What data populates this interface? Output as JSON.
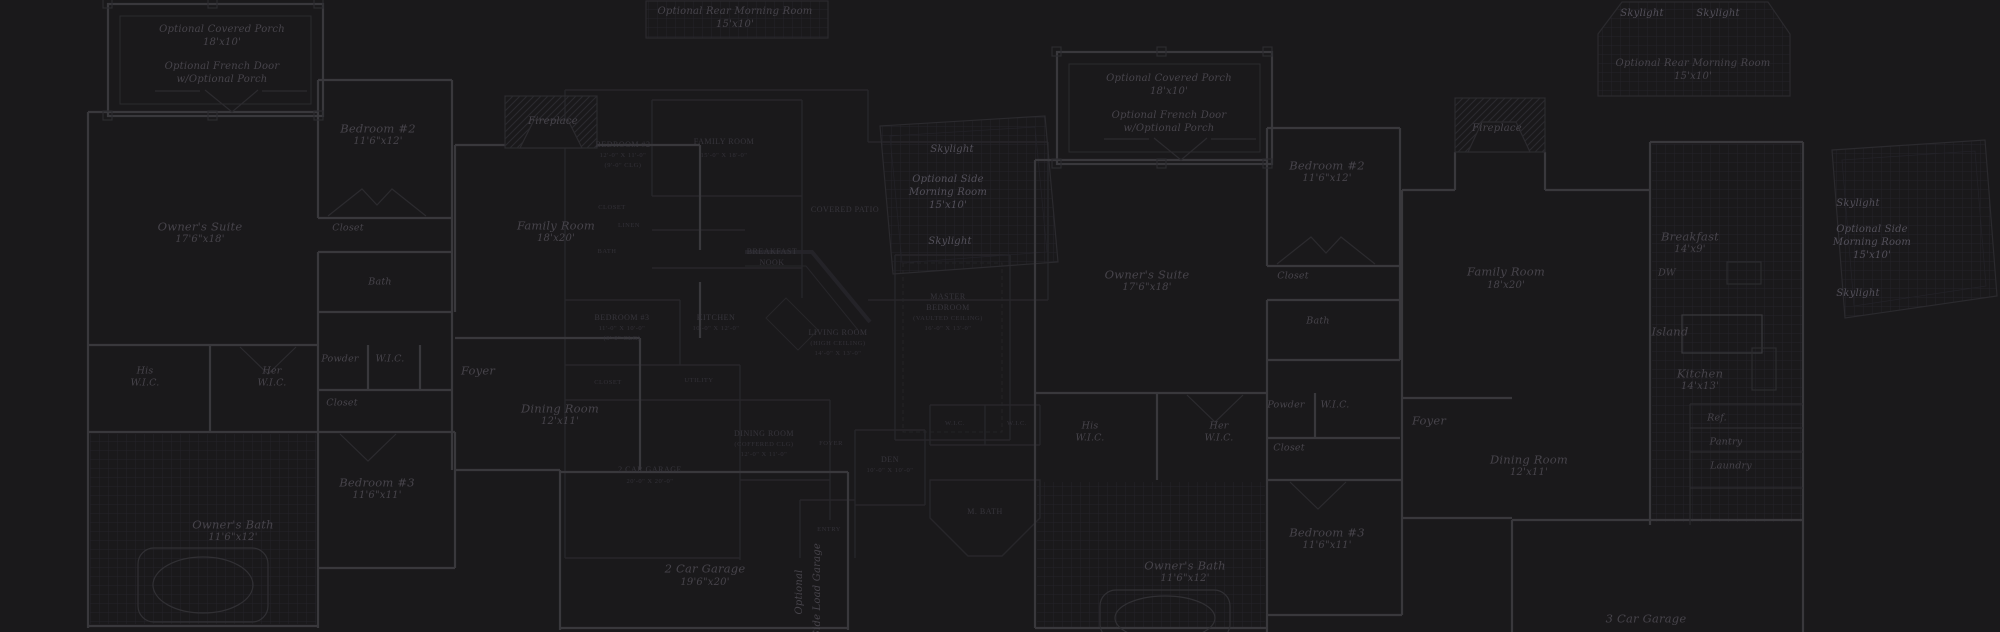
{
  "canvas": {
    "background": "#1a191b",
    "wall_color": "#39383c",
    "faint_wall_color": "#27262a",
    "label_color": "#47444b",
    "caps_label_color": "#37353c",
    "skylight_label_color": "#53505a"
  },
  "plan_left": {
    "covered_porch": {
      "title": "Optional Covered Porch",
      "dims": "18'x10'"
    },
    "french_door": {
      "line1": "Optional French Door",
      "line2": "w/Optional Porch"
    },
    "rear_morning_room": {
      "title": "Optional Rear Morning Room",
      "dims": "15'x10'"
    },
    "skylight_top": "Skylight",
    "side_morning_room": {
      "line1": "Optional Side",
      "line2": "Morning Room",
      "dims": "15'x10'"
    },
    "skylight_bottom": "Skylight",
    "bedroom2": {
      "name": "Bedroom #2",
      "dims": "11'6\"x12'"
    },
    "bedroom2_closet": "Closet",
    "owners_suite": {
      "name": "Owner's Suite",
      "dims": "17'6\"x18'"
    },
    "bath": "Bath",
    "fireplace": "Fireplace",
    "family_room": {
      "name": "Family Room",
      "dims": "18'x20'"
    },
    "his_wic": {
      "line1": "His",
      "line2": "W.I.C."
    },
    "her_wic": {
      "line1": "Her",
      "line2": "W.I.C."
    },
    "powder": "Powder",
    "wic": "W.I.C.",
    "hall_closet": "Closet",
    "foyer": "Foyer",
    "dining_room": {
      "name": "Dining Room",
      "dims": "12'x11'"
    },
    "bedroom3": {
      "name": "Bedroom #3",
      "dims": "11'6\"x11'"
    },
    "owners_bath": {
      "name": "Owner's Bath",
      "dims": "11'6\"x12'"
    },
    "garage": {
      "name": "2 Car Garage",
      "dims": "19'6\"x20'"
    },
    "side_load_garage": {
      "line1": "Optional",
      "line2": "Side Load Garage"
    }
  },
  "plan_middle": {
    "bedroom2": {
      "lines": [
        "BEDROOM #2",
        "12'-0\" X 11'-0\"",
        "(9'-0\" CLG)"
      ]
    },
    "closet": "CLOSET",
    "linen": "LINEN",
    "bath": "BATH",
    "family_room": {
      "lines": [
        "FAMILY ROOM",
        "15'-0\" X 18'-0\""
      ]
    },
    "breakfast_nook": {
      "lines": [
        "BREAKFAST",
        "NOOK"
      ]
    },
    "kitchen": {
      "lines": [
        "KITCHEN",
        "10'-0\" X 12'-0\""
      ]
    },
    "bedroom3": {
      "lines": [
        "BEDROOM #3",
        "11'-0\" X 10'-0\"",
        "(9'-0\" CLG)"
      ]
    },
    "living_room": {
      "lines": [
        "LIVING ROOM",
        "(HIGH CEILING)",
        "14'-0\" X 13'-0\""
      ]
    },
    "master_bedroom": {
      "lines": [
        "MASTER",
        "BEDROOM",
        "(VAULTED CEILING)",
        "16'-0\" X 13'-0\""
      ]
    },
    "covered_patio": "COVERED PATIO",
    "utility": "UTILITY",
    "closet2": "CLOSET",
    "dining_room": {
      "lines": [
        "DINING ROOM",
        "(COFFERED CLG)",
        "12'-0\" X 11'-0\""
      ]
    },
    "garage": {
      "lines": [
        "2 CAR GARAGE",
        "20'-0\" X 20'-0\""
      ]
    },
    "foyer": "FOYER",
    "wic_left": "W.I.C.",
    "wic_right": "W.I.C.",
    "den": {
      "lines": [
        "DEN",
        "10'-0\" X 10'-0\""
      ]
    },
    "master_bath": "M. BATH",
    "entry": "ENTRY"
  },
  "plan_right": {
    "covered_porch": {
      "title": "Optional Covered Porch",
      "dims": "18'x10'"
    },
    "french_door": {
      "line1": "Optional French Door",
      "line2": "w/Optional Porch"
    },
    "rear_morning_room": {
      "skylight_left": "Skylight",
      "skylight_right": "Skylight",
      "title": "Optional Rear Morning Room",
      "dims": "15'x10'"
    },
    "bedroom2": {
      "name": "Bedroom #2",
      "dims": "11'6\"x12'"
    },
    "bedroom2_closet": "Closet",
    "owners_suite": {
      "name": "Owner's Suite",
      "dims": "17'6\"x18'"
    },
    "bath": "Bath",
    "fireplace": "Fireplace",
    "family_room": {
      "name": "Family Room",
      "dims": "18'x20'"
    },
    "breakfast": {
      "name": "Breakfast",
      "dims": "14'x9'"
    },
    "dw": "DW",
    "island": "Island",
    "kitchen": {
      "name": "Kitchen",
      "dims": "14'x13'"
    },
    "ref": "Ref.",
    "pantry": "Pantry",
    "laundry": "Laundry",
    "skylight_top": "Skylight",
    "side_morning_room": {
      "line1": "Optional Side",
      "line2": "Morning Room",
      "dims": "15'x10'"
    },
    "skylight_bottom": "Skylight",
    "his_wic": {
      "line1": "His",
      "line2": "W.I.C."
    },
    "her_wic": {
      "line1": "Her",
      "line2": "W.I.C."
    },
    "powder": "Powder",
    "wic": "W.I.C.",
    "hall_closet": "Closet",
    "foyer": "Foyer",
    "dining_room": {
      "name": "Dining Room",
      "dims": "12'x11'"
    },
    "bedroom3": {
      "name": "Bedroom #3",
      "dims": "11'6\"x11'"
    },
    "owners_bath": {
      "name": "Owner's Bath",
      "dims": "11'6\"x12'"
    },
    "garage": {
      "name": "3 Car Garage"
    }
  }
}
